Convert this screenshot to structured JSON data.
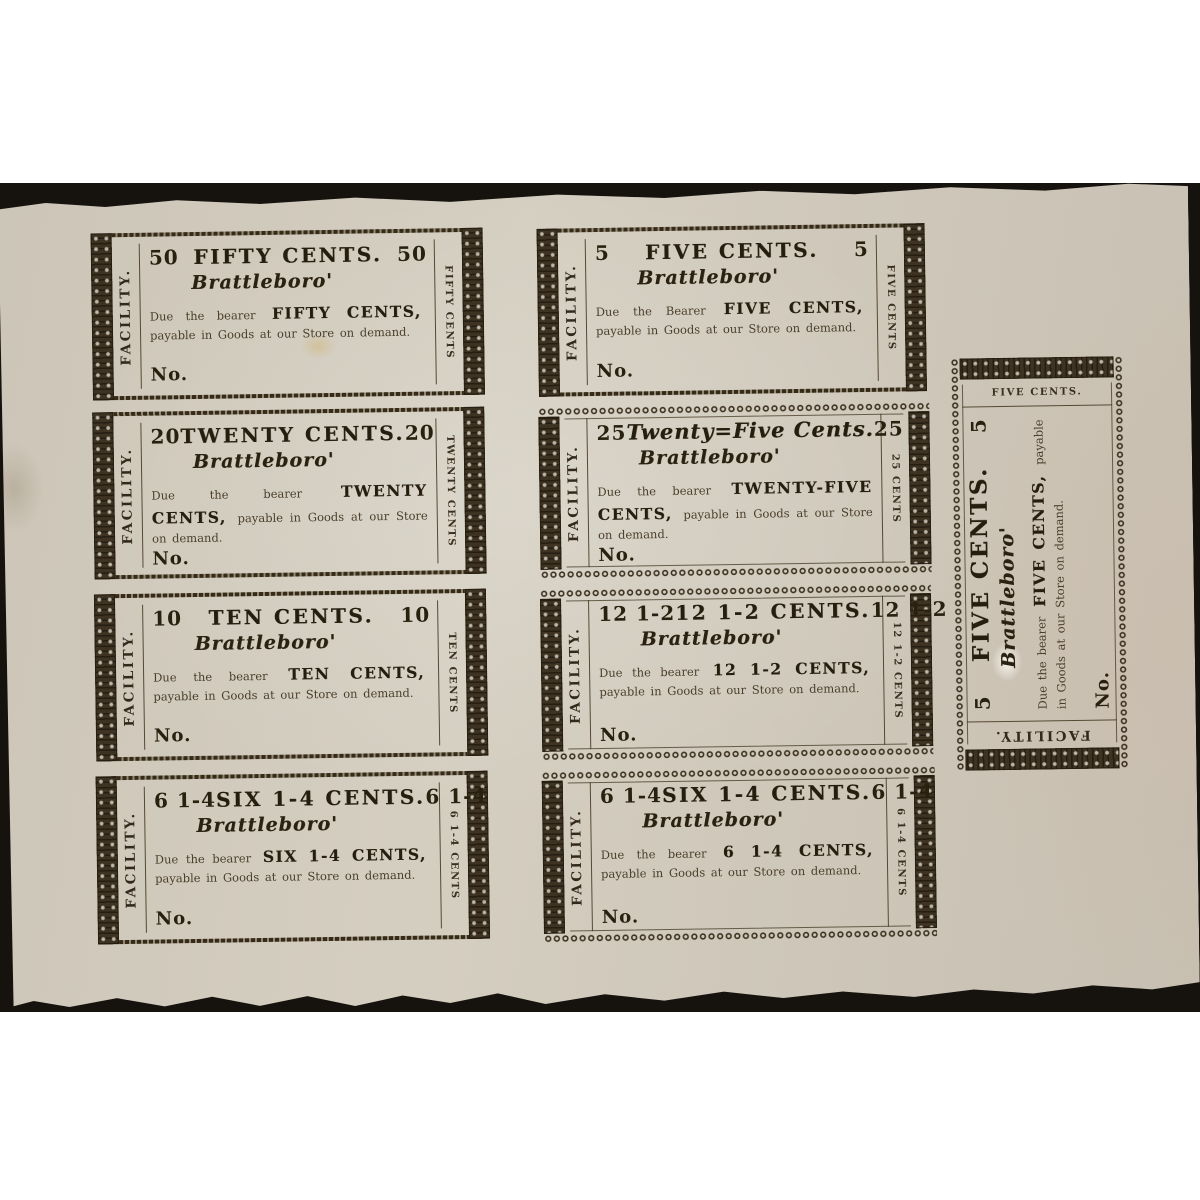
{
  "scene": {
    "page_background": "#ffffff",
    "backdrop_color": "#16130f",
    "paper_color": "#d7d1c4",
    "ink_color": "#2f2617"
  },
  "notes": [
    {
      "corner_left": "50",
      "corner_right": "50",
      "title": "FIFTY CENTS.",
      "city": "Brattleboro'",
      "due_prefix": "Due the bearer",
      "amount": "FIFTY CENTS,",
      "due_suffix": "payable in Goods at our Store on demand.",
      "number_label": "No.",
      "left_vertical": "FACILITY.",
      "right_vertical": "FIFTY CENTS"
    },
    {
      "corner_left": "5",
      "corner_right": "5",
      "title": "FIVE CENTS.",
      "city": "Brattleboro'",
      "due_prefix": "Due the Bearer",
      "amount": "FIVE CENTS,",
      "due_suffix": "payable in Goods at our Store on demand.",
      "number_label": "No.",
      "left_vertical": "FACILITY.",
      "right_vertical": "FIVE CENTS"
    },
    {
      "corner_left": "20",
      "corner_right": "20",
      "title": "TWENTY CENTS.",
      "city": "Brattleboro'",
      "due_prefix": "Due the bearer",
      "amount": "TWENTY CENTS,",
      "due_suffix": "payable in Goods at our Store on demand.",
      "number_label": "No.",
      "left_vertical": "FACILITY.",
      "right_vertical": "TWENTY CENTS"
    },
    {
      "corner_left": "25",
      "corner_right": "25",
      "title": "Twenty=Five Cents.",
      "city": "Brattleboro'",
      "due_prefix": "Due the bearer",
      "amount": "TWENTY-FIVE CENTS,",
      "due_suffix": "payable in Goods at our Store on demand.",
      "number_label": "No.",
      "left_vertical": "FACILITY.",
      "right_vertical": "25 CENTS"
    },
    {
      "corner_left": "10",
      "corner_right": "10",
      "title": "TEN CENTS.",
      "city": "Brattleboro'",
      "due_prefix": "Due the bearer",
      "amount": "TEN CENTS,",
      "due_suffix": "payable in Goods at our Store on demand.",
      "number_label": "No.",
      "left_vertical": "FACILITY.",
      "right_vertical": "TEN CENTS"
    },
    {
      "corner_left": "12 1-2",
      "corner_right": "12 1-2",
      "title": "12 1-2 CENTS.",
      "city": "Brattleboro'",
      "due_prefix": "Due the bearer",
      "amount": "12 1-2 CENTS,",
      "due_suffix": "payable in Goods at our Store on demand.",
      "number_label": "No.",
      "left_vertical": "FACILITY.",
      "right_vertical": "12 1-2 CENTS"
    },
    {
      "corner_left": "6 1-4",
      "corner_right": "6 1-4",
      "title": "SIX 1-4 CENTS.",
      "city": "Brattleboro'",
      "due_prefix": "Due the bearer",
      "amount": "SIX 1-4 CENTS,",
      "due_suffix": "payable in Goods at our Store on demand.",
      "number_label": "No.",
      "left_vertical": "FACILITY.",
      "right_vertical": "6 1-4 CENTS"
    },
    {
      "corner_left": "6 1-4",
      "corner_right": "6 1-4",
      "title": "SIX 1-4 CENTS.",
      "city": "Brattleboro'",
      "due_prefix": "Due the bearer",
      "amount": "6 1-4 CENTS,",
      "due_suffix": "payable in Goods at our Store on demand.",
      "number_label": "No.",
      "left_vertical": "FACILITY.",
      "right_vertical": "6 1-4 CENTS"
    },
    {
      "corner_left": "5",
      "corner_right": "5",
      "title": "FIVE CENTS.",
      "city": "Brattleboro'",
      "due_prefix": "Due the bearer",
      "amount": "FIVE CENTS,",
      "due_suffix": "payable in Goods at our Store on demand.",
      "number_label": "No.",
      "left_vertical": "FACILITY.",
      "right_vertical": "FIVE CENTS."
    }
  ]
}
